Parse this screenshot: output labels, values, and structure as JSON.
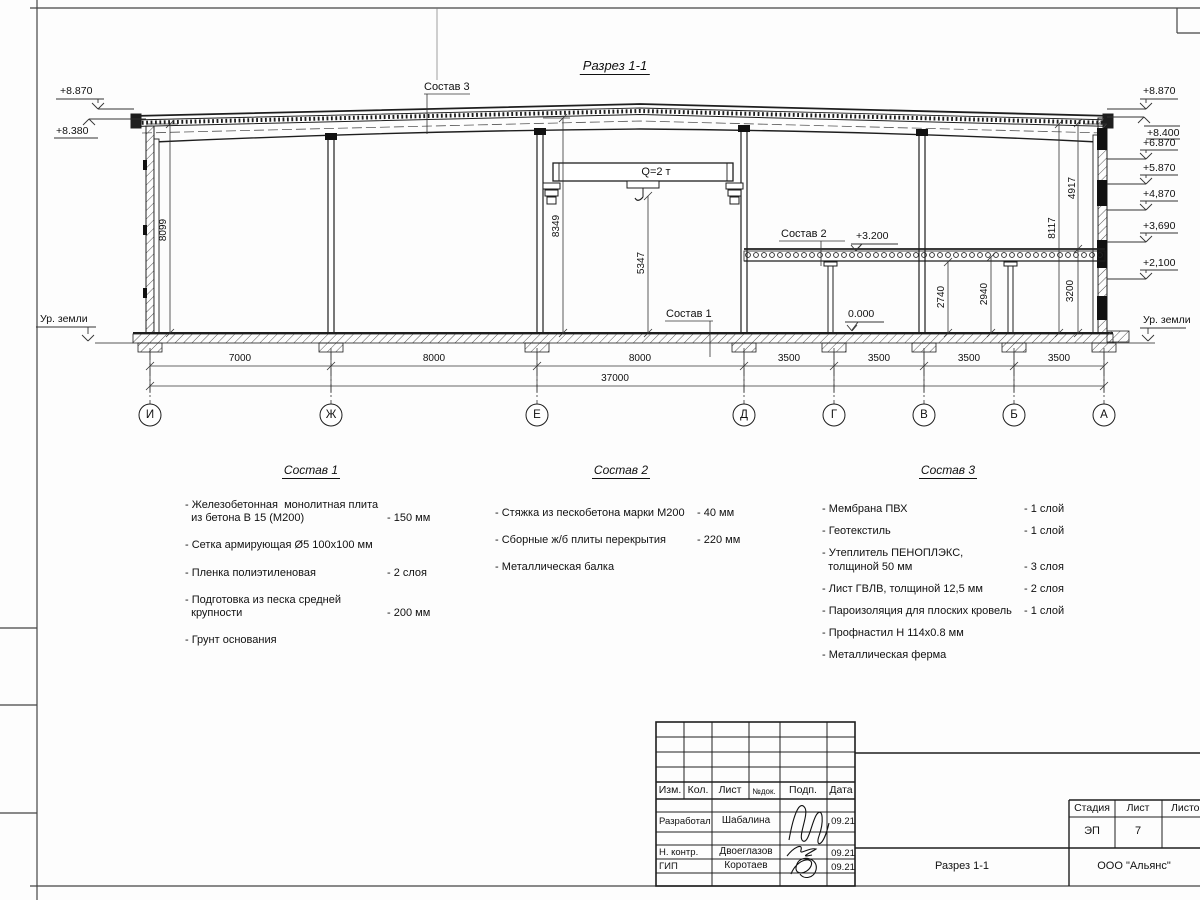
{
  "sheet": {
    "title": "Разрез 1-1"
  },
  "elevations": {
    "left": [
      {
        "label": "+8.870"
      },
      {
        "label": "+8.380"
      },
      {
        "label": "Ур. земли"
      }
    ],
    "right": [
      {
        "label": "+8.870"
      },
      {
        "label": "+8.400"
      },
      {
        "label": "+6.870"
      },
      {
        "label": "+5.870"
      },
      {
        "label": "+4,870"
      },
      {
        "label": "+3,690"
      },
      {
        "label": "+2,100"
      },
      {
        "label": "Ур. земли"
      }
    ],
    "marks": {
      "mezzanine": "+3.200",
      "floor": "0.000"
    }
  },
  "callouts": {
    "sostav1": "Состав 1",
    "sostav2": "Состав 2",
    "sostav3": "Состав 3"
  },
  "crane": {
    "label": "Q=2 т"
  },
  "dims": {
    "vertical": [
      {
        "label": "8099"
      },
      {
        "label": "8349"
      },
      {
        "label": "5347"
      },
      {
        "label": "2740"
      },
      {
        "label": "2940"
      },
      {
        "label": "3200"
      },
      {
        "label": "8117"
      },
      {
        "label": "4917"
      }
    ],
    "spans": [
      {
        "label": "7000"
      },
      {
        "label": "8000"
      },
      {
        "label": "8000"
      },
      {
        "label": "3500"
      },
      {
        "label": "3500"
      },
      {
        "label": "3500"
      },
      {
        "label": "3500"
      }
    ],
    "total": "37000"
  },
  "axes": [
    {
      "label": "И"
    },
    {
      "label": "Ж"
    },
    {
      "label": "Е"
    },
    {
      "label": "Д"
    },
    {
      "label": "Г"
    },
    {
      "label": "В"
    },
    {
      "label": "Б"
    },
    {
      "label": "А"
    }
  ],
  "specs": [
    {
      "title": "Состав 1",
      "items": [
        {
          "text": "- Железобетонная  монолитная плита\n  из бетона В 15 (М200)",
          "value": "- 150 мм"
        },
        {
          "text": "- Сетка армирующая Ø5 100х100 мм",
          "value": ""
        },
        {
          "text": "- Пленка полиэтиленовая",
          "value": "-  2 слоя"
        },
        {
          "text": "- Подготовка из песка средней\n  крупности",
          "value": "- 200 мм"
        },
        {
          "text": "- Грунт основания",
          "value": ""
        }
      ]
    },
    {
      "title": "Состав 2",
      "items": [
        {
          "text": "- Стяжка из пескобетона марки М200",
          "value": "- 40 мм"
        },
        {
          "text": "- Сборные ж/б плиты перекрытия",
          "value": "- 220 мм"
        },
        {
          "text": "- Металлическая балка",
          "value": ""
        }
      ]
    },
    {
      "title": "Состав 3",
      "items": [
        {
          "text": "- Мембрана ПВХ",
          "value": "- 1 слой"
        },
        {
          "text": "- Геотекстиль",
          "value": "- 1 слой"
        },
        {
          "text": "- Утеплитель ПЕНОПЛЭКС,\n  толщиной 50 мм",
          "value": "- 3 слоя"
        },
        {
          "text": "- Лист ГВЛВ, толщиной 12,5 мм",
          "value": "- 2 слоя"
        },
        {
          "text": "- Пароизоляция для плоских кровель",
          "value": "- 1 слой"
        },
        {
          "text": "- Профнастил Н 114х0.8 мм",
          "value": ""
        },
        {
          "text": "- Металлическая ферма",
          "value": ""
        }
      ]
    }
  ],
  "title_block": {
    "columns": [
      "Изм.",
      "Кол.",
      "Лист",
      "№док.",
      "Подп.",
      "Дата"
    ],
    "rows": [
      {
        "role": "Разработал",
        "name": "Шабалина",
        "date": "09.21"
      },
      {
        "role": "Н. контр.",
        "name": "Двоеглазов",
        "date": "09.21"
      },
      {
        "role": "ГИП",
        "name": "Коротаев",
        "date": "09.21"
      }
    ],
    "stage_label": "Стадия",
    "sheet_label": "Лист",
    "sheets_label": "Листов",
    "stage_value": "ЭП",
    "sheet_value": "7",
    "drawing_name": "Разрез 1-1",
    "company": "ООО \"Альянс\""
  }
}
